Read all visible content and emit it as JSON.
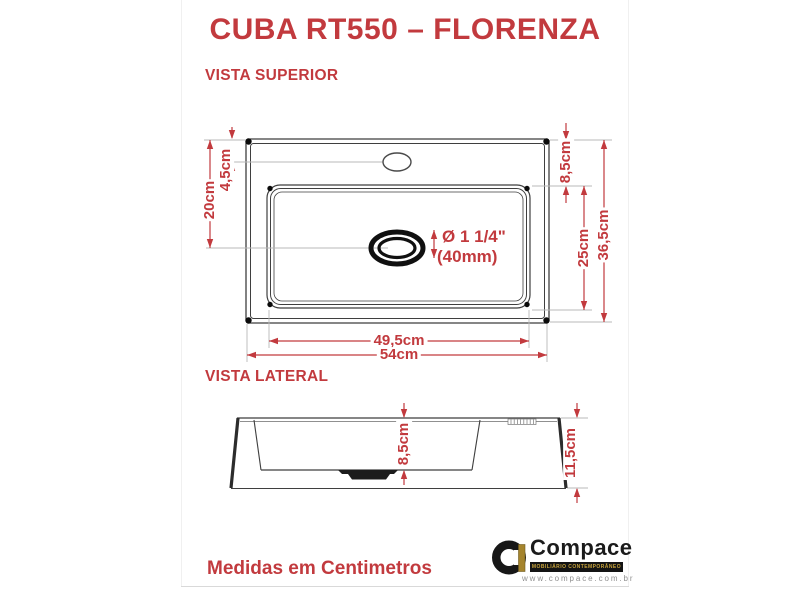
{
  "title": "CUBA RT550 – FLORENZA",
  "top_view": {
    "label": "VISTA SUPERIOR",
    "dim_faucet_offset": "4,5cm",
    "dim_drain_from_top": "20cm",
    "dim_deck_to_basin": "8,5cm",
    "dim_basin_length": "25cm",
    "dim_total_depth": "36,5cm",
    "dim_basin_width": "49,5cm",
    "dim_total_width": "54cm",
    "drain_diameter": "Ø 1 1/4\"",
    "drain_diameter_mm": "(40mm)"
  },
  "side_view": {
    "label": "VISTA LATERAL",
    "dim_basin_height": "8,5cm",
    "dim_total_height": "11,5cm"
  },
  "footer": {
    "note": "Medidas em Centimetros"
  },
  "brand": {
    "name": "Compace",
    "tagline": "MOBILIÁRIO CONTEMPORÂNEO",
    "url": "www.compace.com.br"
  },
  "colors": {
    "accent_red": "#c23a3e",
    "line_dark": "#3f3f3f",
    "logo_gold": "#a5842d"
  }
}
